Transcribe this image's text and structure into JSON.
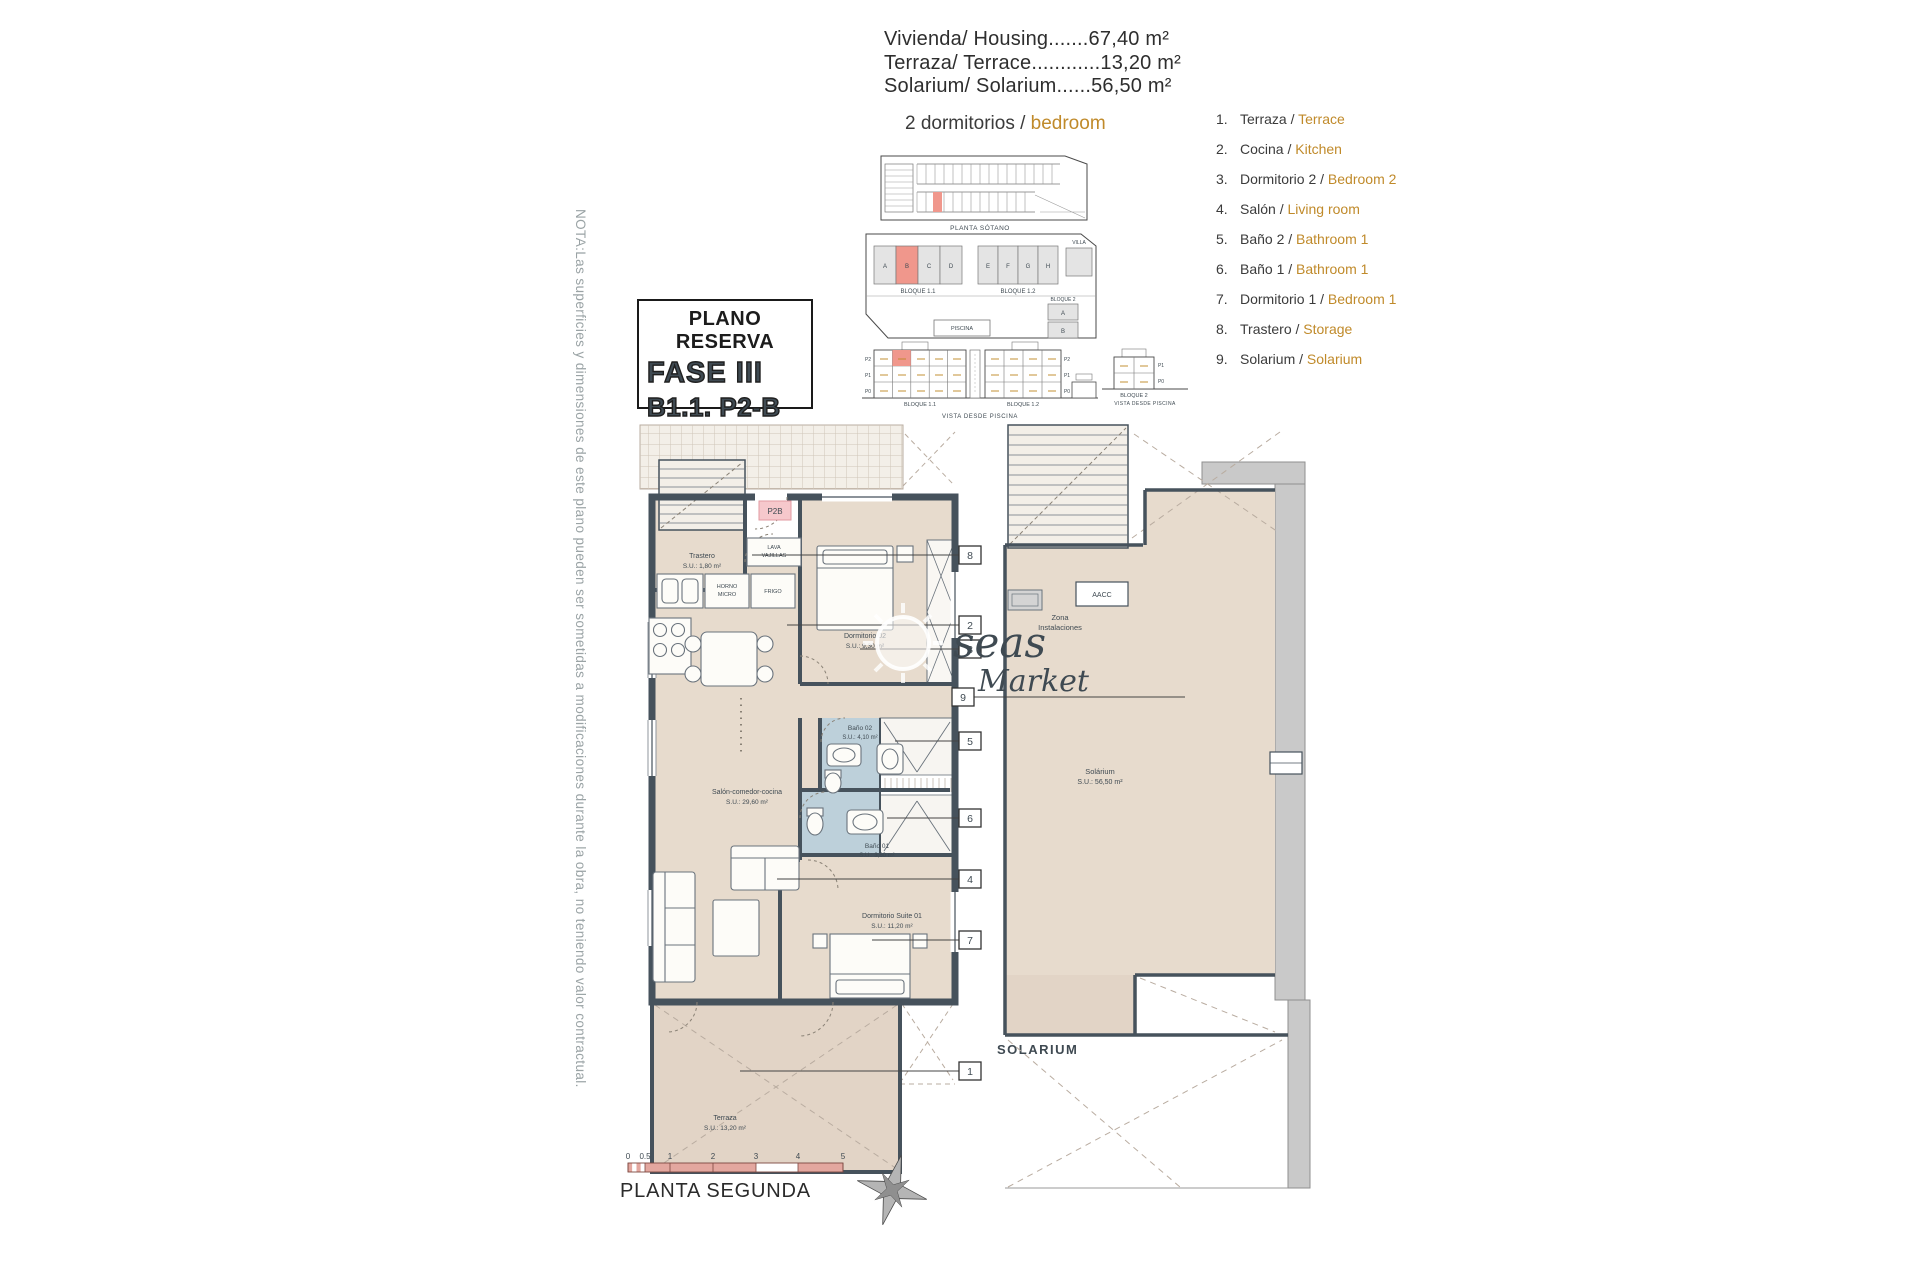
{
  "header": {
    "areas": [
      "Vivienda/ Housing.......67,40 m²",
      "Terraza/ Terrace............13,20 m²",
      "Solarium/ Solarium......56,50 m²"
    ],
    "unit_type_prefix": "2 dormitorios / ",
    "unit_type_highlight": "bedroom"
  },
  "legend": {
    "sep": " / ",
    "items": [
      {
        "num": "1.",
        "es": "Terraza",
        "en": "Terrace"
      },
      {
        "num": "2.",
        "es": "Cocina",
        "en": "Kitchen"
      },
      {
        "num": "3.",
        "es": "Dormitorio 2",
        "en": "Bedroom 2"
      },
      {
        "num": "4.",
        "es": "Salón",
        "en": "Living room"
      },
      {
        "num": "5.",
        "es": "Baño 2",
        "en": "Bathroom 1"
      },
      {
        "num": "6.",
        "es": "Baño 1",
        "en": "Bathroom 1"
      },
      {
        "num": "7.",
        "es": "Dormitorio 1",
        "en": "Bedroom 1"
      },
      {
        "num": "8.",
        "es": "Trastero",
        "en": "Storage"
      },
      {
        "num": "9.",
        "es": "Solarium",
        "en": "Solarium"
      }
    ]
  },
  "reserve_box": {
    "title": "PLANO RESERVA",
    "fase": "FASE III",
    "unit": "B1.1. P2-B"
  },
  "note": "NOTA:Las superficies y dimensiones de este plano pueden ser sometidas a modificaciones durante la obra, no teniendo valor contractual.",
  "site_diagrams": {
    "basement_caption": "PLANTA SÓTANO",
    "site": {
      "bloque11": "BLOQUE 1.1",
      "bloque12": "BLOQUE 1.2",
      "bloque2": "BLOQUE 2",
      "villa": "VILLA",
      "piscina": "PISCINA",
      "units_b11": [
        "A",
        "B",
        "C",
        "D"
      ],
      "units_b12": [
        "E",
        "F",
        "G",
        "H"
      ],
      "units_b2": [
        "A",
        "B"
      ]
    },
    "elevation": {
      "caption": "VISTA DESDE PISCINA",
      "bloque11": "BLOQUE 1.1",
      "bloque12": "BLOQUE 1.2",
      "floors": [
        "P2",
        "P1",
        "P0"
      ]
    },
    "elevation2": {
      "caption": "VISTA DESDE PISCINA",
      "bloque2": "BLOQUE 2",
      "floors": [
        "P1",
        "P0"
      ]
    }
  },
  "floor_plan": {
    "trastero_name": "Trastero",
    "trastero_area": "S.U.: 1,80 m²",
    "dorm2_name": "Dormitorio 02",
    "dorm2_area": "S.U.: 9,30 m²",
    "bano2_name": "Baño 02",
    "bano2_area": "S.U.: 4,10 m²",
    "bano1_name": "Baño 01",
    "bano1_area": "S.U.: 3,60 m²",
    "salon_name": "Salón-comedor-cocina",
    "salon_area": "S.U.: 29,60 m²",
    "suite_name": "Dormitorio Suite 01",
    "suite_area": "S.U.: 11,20 m²",
    "terraza_name": "Terraza",
    "terraza_area": "S.U.: 13,20 m²",
    "horno1": "HORNO",
    "horno2": "MICRO",
    "frigo": "FRIGO",
    "lava1": "LAVA",
    "lava2": "VAJILLAS",
    "unit_marker": "P2B",
    "callouts": {
      "c1": "1",
      "c2": "2",
      "c3": "3",
      "c4": "4",
      "c5": "5",
      "c6": "6",
      "c7": "7",
      "c8": "8",
      "c9": "9"
    }
  },
  "solarium_plan": {
    "room_name": "Solárium",
    "room_area": "S.U.: 56,50 m²",
    "zona1": "Zona",
    "zona2": "Instalaciones",
    "aacc": "AACC",
    "caption": "SOLARIUM"
  },
  "footer": {
    "scale_ticks": [
      "0",
      "0.5",
      "1",
      "2",
      "3",
      "4",
      "5"
    ],
    "plan_name": "PLANTA SEGUNDA"
  },
  "watermark": {
    "t1": "seas",
    "t2": "Market"
  },
  "colors": {
    "accent": "#c08a2a",
    "wall": "#46525c",
    "room_tan": "#e7dbcd",
    "bath_blue": "#bdd0da",
    "highlight_red": "#f0978c",
    "scale_pink": "#e3a79f"
  }
}
